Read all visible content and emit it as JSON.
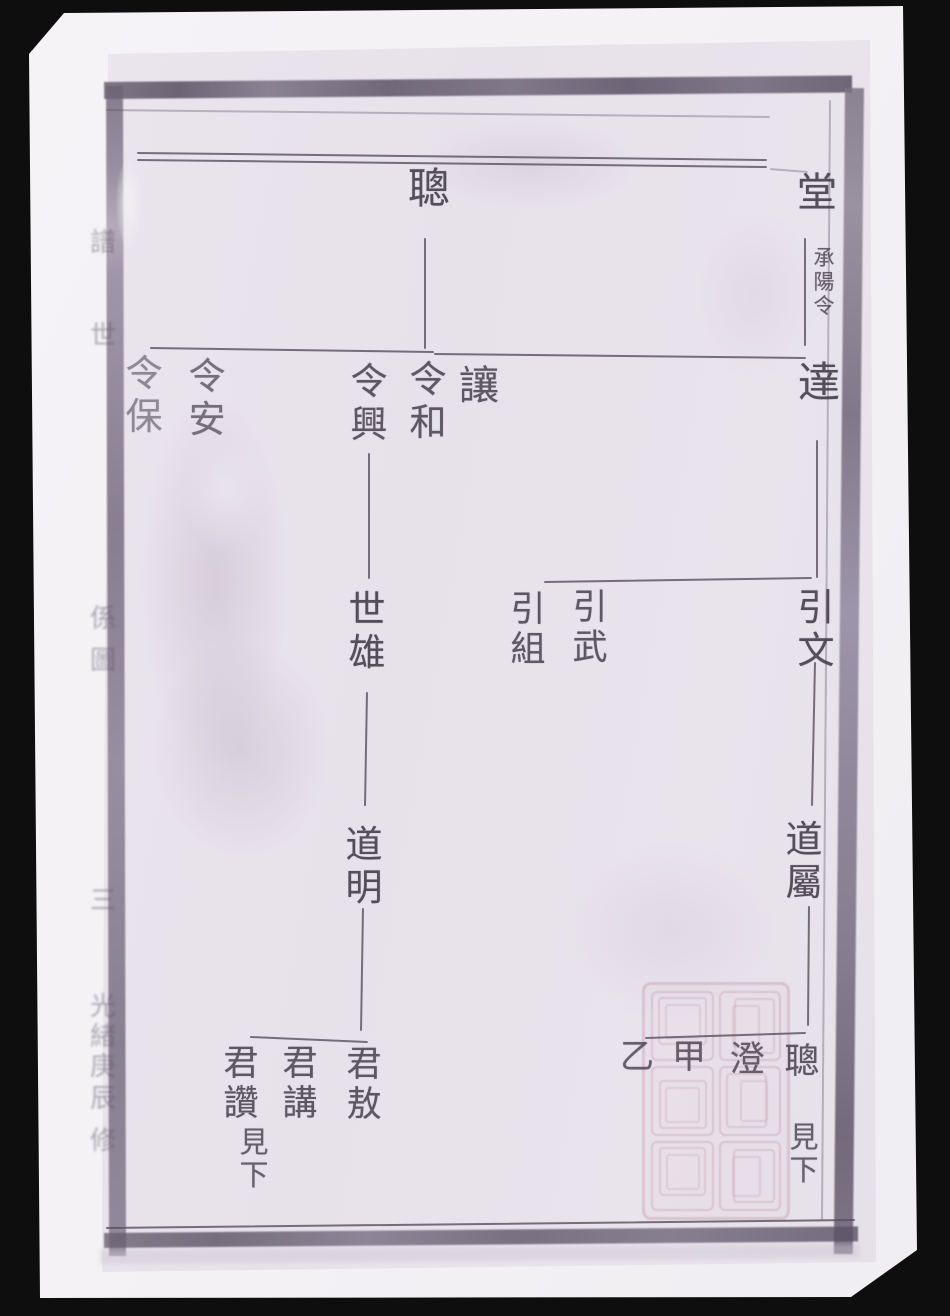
{
  "document": {
    "kind": "scanned Chinese genealogy (family tree) page",
    "seal": {
      "present": true,
      "color": "#bc8896",
      "style": "faint square seal-script stamp, grid of glyph cells",
      "position": "bottom-right of page"
    }
  },
  "chart": {
    "nodes": [
      {
        "id": "cong-top",
        "text": "聰",
        "x": 406,
        "y": 166,
        "w": 46,
        "fs": 42,
        "op": 0.9
      },
      {
        "id": "tang",
        "text": "堂",
        "x": 795,
        "y": 170,
        "w": 44,
        "fs": 40,
        "op": 0.9
      },
      {
        "id": "note-chengyangling",
        "text": "承陽令",
        "x": 812,
        "y": 246,
        "w": 24,
        "fs": 21,
        "op": 0.8
      },
      {
        "id": "da",
        "text": "達",
        "x": 796,
        "y": 360,
        "w": 46,
        "fs": 42,
        "op": 0.9
      },
      {
        "id": "rang",
        "text": "讓",
        "x": 458,
        "y": 363,
        "w": 42,
        "fs": 40,
        "op": 0.85
      },
      {
        "id": "ling-he",
        "text": "令和",
        "x": 408,
        "y": 360,
        "w": 40,
        "fs": 37,
        "op": 0.85
      },
      {
        "id": "ling-xing",
        "text": "令興",
        "x": 349,
        "y": 362,
        "w": 40,
        "fs": 37,
        "op": 0.85
      },
      {
        "id": "ling-an",
        "text": "令安",
        "x": 187,
        "y": 357,
        "w": 40,
        "fs": 37,
        "op": 0.7
      },
      {
        "id": "ling-bao",
        "text": "令保",
        "x": 124,
        "y": 354,
        "w": 40,
        "fs": 37,
        "op": 0.55
      },
      {
        "id": "yin-wen",
        "text": "引文",
        "x": 796,
        "y": 588,
        "w": 40,
        "fs": 37,
        "op": 0.9
      },
      {
        "id": "yin-wu",
        "text": "引武",
        "x": 571,
        "y": 588,
        "w": 38,
        "fs": 35,
        "op": 0.85
      },
      {
        "id": "yin-zu",
        "text": "引組",
        "x": 509,
        "y": 590,
        "w": 38,
        "fs": 35,
        "op": 0.85
      },
      {
        "id": "shi-xiong",
        "text": "世雄",
        "x": 347,
        "y": 590,
        "w": 40,
        "fs": 37,
        "op": 0.9
      },
      {
        "id": "dao-ming",
        "text": "道明",
        "x": 344,
        "y": 825,
        "w": 40,
        "fs": 37,
        "op": 0.9
      },
      {
        "id": "dao-shu",
        "text": "道屬",
        "x": 784,
        "y": 820,
        "w": 40,
        "fs": 37,
        "op": 0.9
      },
      {
        "id": "jun-ao",
        "text": "君敖",
        "x": 345,
        "y": 1045,
        "w": 38,
        "fs": 35,
        "op": 0.85
      },
      {
        "id": "jun-jiang",
        "text": "君講",
        "x": 281,
        "y": 1044,
        "w": 38,
        "fs": 35,
        "op": 0.85
      },
      {
        "id": "jun-zan",
        "text": "君讚",
        "x": 222,
        "y": 1044,
        "w": 38,
        "fs": 35,
        "op": 0.85
      },
      {
        "id": "see-below-left",
        "text": "見下",
        "x": 238,
        "y": 1127,
        "w": 32,
        "fs": 29,
        "op": 0.8
      },
      {
        "id": "cong-bottom",
        "text": "聰",
        "x": 783,
        "y": 1042,
        "w": 38,
        "fs": 35,
        "op": 0.85
      },
      {
        "id": "cheng",
        "text": "澄",
        "x": 728,
        "y": 1040,
        "w": 38,
        "fs": 35,
        "op": 0.8
      },
      {
        "id": "jia",
        "text": "甲",
        "x": 671,
        "y": 1038,
        "w": 36,
        "fs": 34,
        "op": 0.8
      },
      {
        "id": "yi",
        "text": "乙",
        "x": 619,
        "y": 1038,
        "w": 36,
        "fs": 34,
        "op": 0.8
      },
      {
        "id": "see-below-right",
        "text": "見下",
        "x": 788,
        "y": 1122,
        "w": 32,
        "fs": 29,
        "op": 0.8
      }
    ],
    "lines": [
      {
        "id": "v-cong-top",
        "x1": 426,
        "y1": 238,
        "x2": 426,
        "y2": 349,
        "w": 2
      },
      {
        "id": "h-siblings-left",
        "x1": 150,
        "y1": 347,
        "x2": 434,
        "y2": 351,
        "w": 2
      },
      {
        "id": "h-siblings-right",
        "x1": 434,
        "y1": 353,
        "x2": 806,
        "y2": 357,
        "w": 2
      },
      {
        "id": "v-tang-da",
        "x1": 806,
        "y1": 238,
        "x2": 806,
        "y2": 346,
        "w": 2
      },
      {
        "id": "v-da-down",
        "x1": 818,
        "y1": 440,
        "x2": 818,
        "y2": 578,
        "w": 2
      },
      {
        "id": "h-yin-siblings",
        "x1": 544,
        "y1": 581,
        "x2": 812,
        "y2": 577,
        "w": 2
      },
      {
        "id": "v-yinwen-down",
        "x1": 816,
        "y1": 662,
        "x2": 813,
        "y2": 806,
        "w": 2
      },
      {
        "id": "v-daoshu-down",
        "x1": 810,
        "y1": 906,
        "x2": 809,
        "y2": 1026,
        "w": 2
      },
      {
        "id": "h-bottom-right",
        "x1": 645,
        "y1": 1037,
        "x2": 806,
        "y2": 1032,
        "w": 2
      },
      {
        "id": "v-lingxing-down",
        "x1": 370,
        "y1": 453,
        "x2": 370,
        "y2": 579,
        "w": 2
      },
      {
        "id": "v-shixiong-down",
        "x1": 368,
        "y1": 692,
        "x2": 366,
        "y2": 806,
        "w": 2
      },
      {
        "id": "v-daoming-down",
        "x1": 364,
        "y1": 908,
        "x2": 362,
        "y2": 1031,
        "w": 2
      },
      {
        "id": "h-bottom-left",
        "x1": 250,
        "y1": 1036,
        "x2": 368,
        "y2": 1041,
        "w": 2
      },
      {
        "id": "frame-top-a",
        "x1": 137,
        "y1": 152,
        "x2": 767,
        "y2": 159,
        "w": 2
      },
      {
        "id": "frame-top-b",
        "x1": 137,
        "y1": 159,
        "x2": 767,
        "y2": 166,
        "w": 1.5
      },
      {
        "id": "frame-top-fragment",
        "x1": 770,
        "y1": 168,
        "x2": 808,
        "y2": 171,
        "w": 1.5,
        "faint": true
      },
      {
        "id": "frame-under-band",
        "x1": 106,
        "y1": 109,
        "x2": 770,
        "y2": 116,
        "w": 2,
        "faint": true
      },
      {
        "id": "frame-right-inner",
        "x1": 831,
        "y1": 100,
        "x2": 823,
        "y2": 1220,
        "w": 1.5,
        "faint": true
      },
      {
        "id": "frame-bottom",
        "x1": 106,
        "y1": 1227,
        "x2": 855,
        "y2": 1219,
        "w": 2
      }
    ],
    "edge_chars": [
      {
        "text": "譜",
        "y": 222
      },
      {
        "text": "世",
        "y": 315
      },
      {
        "text": "係",
        "y": 598
      },
      {
        "text": "圖",
        "y": 640
      },
      {
        "text": "三",
        "y": 880
      },
      {
        "text": "光",
        "y": 986
      },
      {
        "text": "緒",
        "y": 1016
      },
      {
        "text": "庚",
        "y": 1046
      },
      {
        "text": "辰",
        "y": 1078
      },
      {
        "text": "修",
        "y": 1120
      }
    ],
    "relations": [
      "聰 — 讓 令和 令興 令安 令保 (sibling rule line)",
      "堂 …承陽令… 達",
      "達 — 引文 引武 引組",
      "引文 — 道屬",
      "道屬 — 聰 澄 甲 乙",
      "聰 — 見下",
      "令興 — 世雄 — 道明 — 君敖 君講 君讚",
      "君讚 — 見下"
    ]
  },
  "colors": {
    "ink": "#453f4b",
    "rule_line": "#56505d",
    "paper": "#f4f2f5",
    "page_photo": "#e8e2ea",
    "border_smudge": "#6b6374",
    "seal": "#bc8896",
    "background": "#0e0e0e"
  }
}
